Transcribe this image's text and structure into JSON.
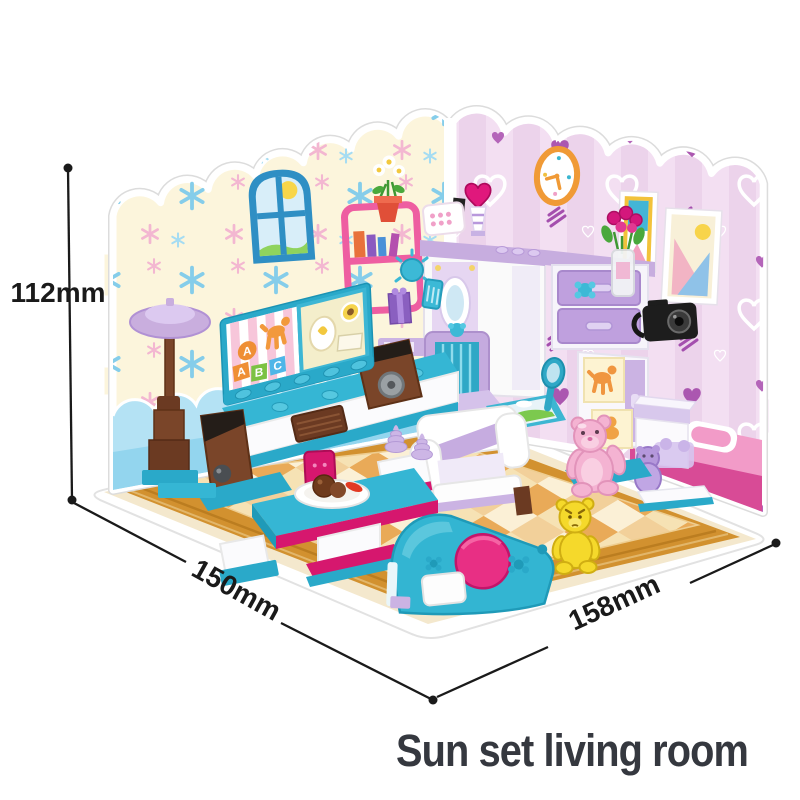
{
  "title": {
    "text": "Sun set living room",
    "color": "#35383f"
  },
  "dimensions": {
    "height": "112mm",
    "depth": "150mm",
    "width": "158mm"
  },
  "palette": {
    "background": "#ffffff",
    "dimension_ink": "#1a1a1a",
    "left_wall": "#fcf5dc",
    "flake_blue": "#85cdea",
    "flake_pink": "#f3b7d1",
    "wainscot_blue": "#a9def2",
    "right_wall": "#f3dff2",
    "heart_purple": "#ab57b0",
    "baseboard_pink": "#d84b96",
    "floor_wood": "#d2912f",
    "rug_orange": "#e9aa58",
    "rug_cream": "#f6dca8",
    "toy_teal": "#35b6d4",
    "toy_magenta": "#e3197d",
    "toy_lavender": "#c9aede",
    "toy_brown": "#7a4529",
    "bear_pink": "#f4b3d2",
    "bear_yellow": "#f5d92b"
  },
  "scene": {
    "tv_blocks": [
      "A",
      "B",
      "C"
    ],
    "balloon_letter": "A",
    "objects": [
      "arched-window",
      "wall-clock",
      "picture-frames",
      "heart-trophy",
      "radio",
      "pink-bookshelf-with-flower-pot",
      "corner-mirror-unit",
      "hair-brush-and-comb",
      "gift-box",
      "dresser-with-flower-vase-and-camera",
      "cabinet-with-balloon-dog-art",
      "tv-board-with-abc-blocks",
      "tv-stand-with-speakers",
      "floor-lamp",
      "white-armchair",
      "lavender-chair",
      "magenta-desk-chair",
      "coffee-table-with-dessert-plate",
      "ice-cream-swirls",
      "pink-teddy-bear",
      "yellow-teddy-bear",
      "purple-bear-toy",
      "dressing-table-with-round-mirror",
      "checkered-rug"
    ]
  }
}
